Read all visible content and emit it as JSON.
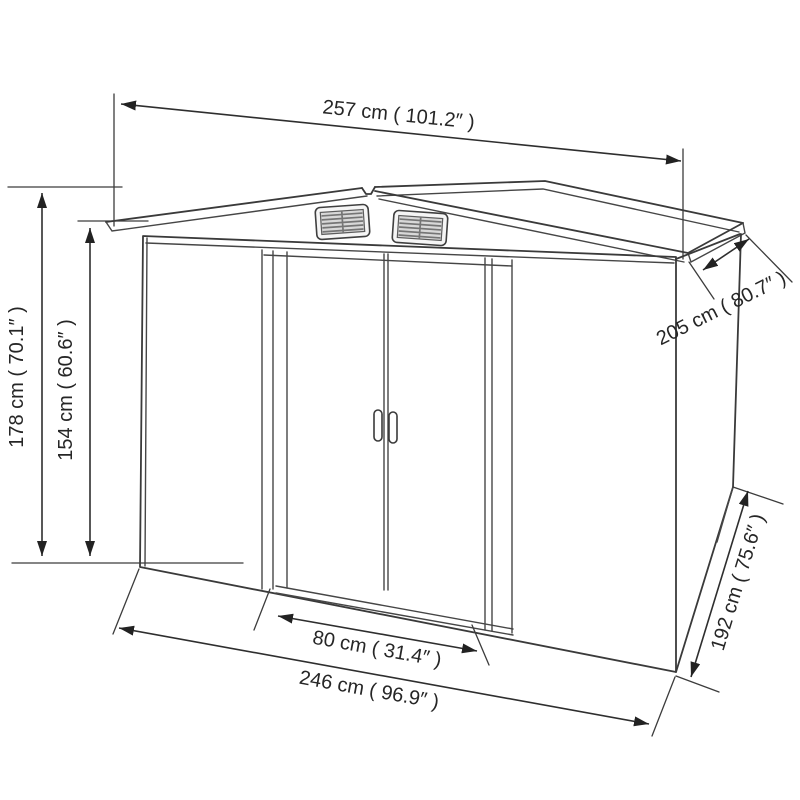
{
  "diagram": {
    "kind": "technical-dimension-drawing",
    "subject": "metal garden shed with double sliding doors and two roof vents",
    "background_color": "#ffffff",
    "line_color": "#3a3a3a",
    "text_color": "#262626",
    "units": [
      "cm",
      "inches"
    ],
    "dimensions": [
      {
        "id": "width_roof_top",
        "label": "257 cm ( 101.2″ )",
        "value_cm": 257,
        "value_in": 101.2,
        "placement": "top horizontal"
      },
      {
        "id": "height_total",
        "label": "178 cm ( 70.1″ )",
        "value_cm": 178,
        "value_in": 70.1,
        "placement": "left vertical outer"
      },
      {
        "id": "height_wall",
        "label": "154 cm ( 60.6″ )",
        "value_cm": 154,
        "value_in": 60.6,
        "placement": "left vertical inner"
      },
      {
        "id": "depth_roof",
        "label": "205 cm ( 80.7″ )",
        "value_cm": 205,
        "value_in": 80.7,
        "placement": "upper right diagonal"
      },
      {
        "id": "door_width",
        "label": "80 cm ( 31.4″ )",
        "value_cm": 80,
        "value_in": 31.4,
        "placement": "bottom inner"
      },
      {
        "id": "width_base",
        "label": "246 cm ( 96.9″ )",
        "value_cm": 246,
        "value_in": 96.9,
        "placement": "bottom outer"
      },
      {
        "id": "depth_base",
        "label": "192 cm ( 75.6″ )",
        "value_cm": 192,
        "value_in": 75.6,
        "placement": "lower right diagonal"
      }
    ]
  }
}
